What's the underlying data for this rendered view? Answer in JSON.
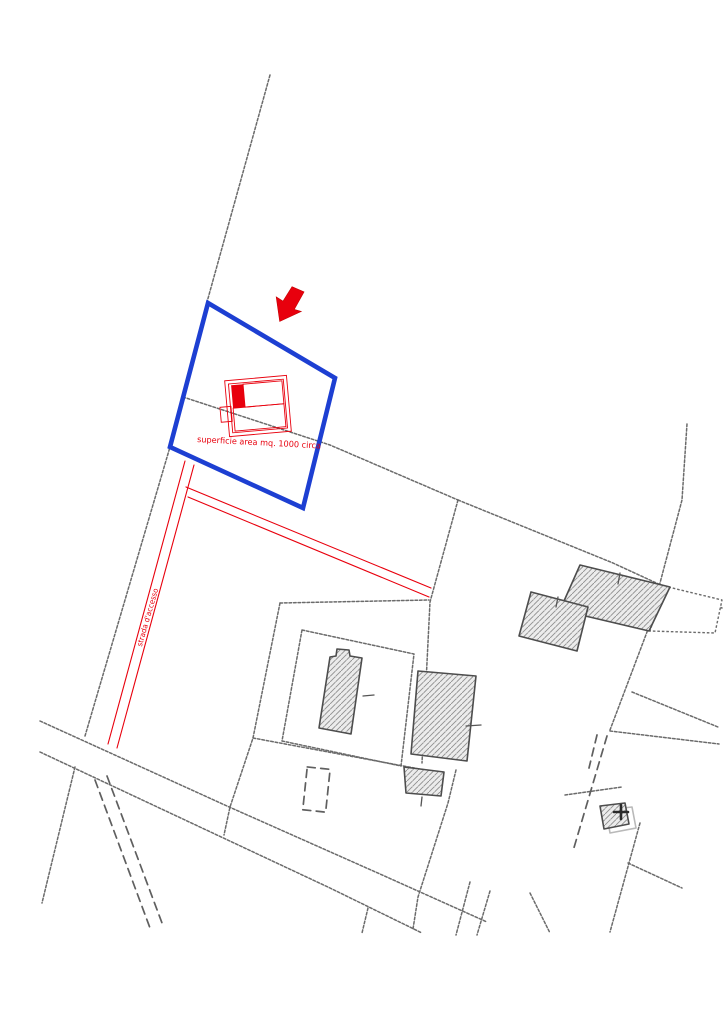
{
  "map": {
    "title": "cadastral site plan extract",
    "annotations": {
      "area_label": "superficie area mq. 1000 circa",
      "road_label": "strada d'accesso"
    },
    "colors": {
      "highlight_blue": "#1d3fd2",
      "annotation_red": "#e8000d",
      "boundary_gray": "#6b6b6b",
      "building_fill": "#ececec",
      "building_stroke": "#4d4d4d"
    },
    "features": {
      "highlighted_parcel": "parcel outlined in blue",
      "subject_building": "red hatched building inside highlighted parcel",
      "location_arrow": "red arrow pointing at highlighted parcel",
      "access_road": "red double line path to the public road",
      "neighbor_buildings": "gray hatched buildings on adjacent parcels",
      "public_road": "double black line road at bottom",
      "dashed_track": "dashed double track below the road"
    }
  }
}
